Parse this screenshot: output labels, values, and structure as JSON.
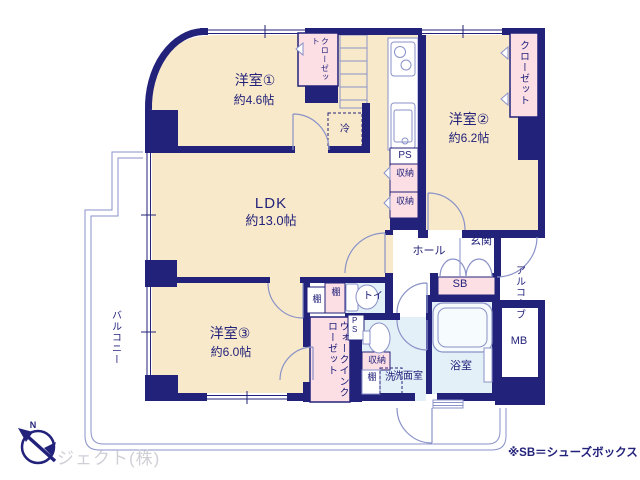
{
  "rooms": {
    "yoshitsu1": {
      "name": "洋室①",
      "size": "約4.6帖"
    },
    "yoshitsu2": {
      "name": "洋室②",
      "size": "約6.2帖"
    },
    "yoshitsu3": {
      "name": "洋室③",
      "size": "約6.0帖"
    },
    "ldk": {
      "name": "LDK",
      "size": "約13.0帖"
    }
  },
  "labels": {
    "closet": "クローゼット",
    "walk_in_closet": "ウォークインクローゼット",
    "balcony": "バルコニー",
    "alcove": "アルコーブ",
    "hall": "ホール",
    "genkan": "玄関",
    "toilet": "トイレ",
    "bathroom": "浴室",
    "washroom": "洗面室",
    "fridge": "冷",
    "ps": "PS",
    "sb": "SB",
    "mb": "MB",
    "storage": "収納",
    "shelf": "棚",
    "washer": "洗",
    "compass_n": "N"
  },
  "footer": {
    "note": "※SB＝シューズボックス",
    "company": "ジェクト(株)"
  },
  "colors": {
    "wall": "#23227b",
    "room_floor": "#f8e9ca",
    "closet_fill": "#fbdfe5",
    "wet_area": "#e3f0f8",
    "thin_line": "#8a92c8",
    "company_gray": "#cfcfd6"
  }
}
